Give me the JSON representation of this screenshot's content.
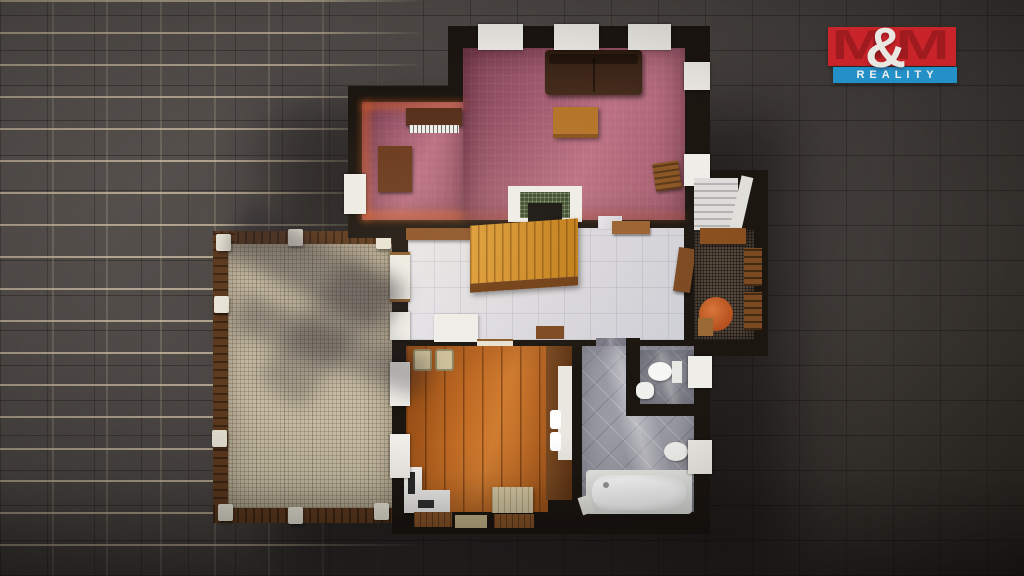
{
  "scene": {
    "type": "3d-floorplan-top-down-render",
    "description": "Real-estate 3D render of a house ground-floor plan placed on a dark gray ceramic tile background",
    "palette": {
      "background_tile_dark": "#46413e",
      "background_grout_light": "#d8c9aa",
      "wall_black": "#1c1611",
      "living_room_pink": "#b06a7c",
      "hallway_marble": "#dfdfe3",
      "wood_floor_orange": "#bc6a22",
      "terrace_beige": "#c6bca4",
      "bathroom_gray": "#9b9ba5",
      "balcony_dark_brown": "#584a3d",
      "staircase_gold": "#d9992e",
      "window_white": "#eeede7",
      "glow_orange": "#ff7323"
    }
  },
  "logo": {
    "m_left": "M",
    "ampersand": "&",
    "m_right": "M",
    "banner": "REALITY",
    "colors": {
      "block_red": "#c8242a",
      "letter_dark_red": "#a01b20",
      "banner_blue": "#2390c7",
      "text_white": "#eae8e3"
    }
  },
  "floorplan": {
    "rooms": [
      {
        "name": "living-room",
        "floor": "pink-mauve carpet",
        "furniture": [
          "sofa",
          "upright-piano",
          "desk",
          "table",
          "chair",
          "fireplace"
        ]
      },
      {
        "name": "hallway",
        "floor": "white-marble tiles",
        "furniture": [
          "wooden-staircase",
          "wood-shelf",
          "white-rug",
          "doormat",
          "radiator-shelf",
          "balcony-door"
        ]
      },
      {
        "name": "terrace",
        "floor": "beige-stone mosaic",
        "furniture": [
          "wood-railing",
          "white-posts",
          "tree-shadows"
        ]
      },
      {
        "name": "kitchen-living-room",
        "floor": "wood-planks",
        "furniture": [
          "pouf",
          "pouf",
          "white-desk-counter",
          "bench",
          "kitchen-counter",
          "sink-basins"
        ]
      },
      {
        "name": "bathroom",
        "floor": "gray-diagonal-tiles",
        "furniture": [
          "bathtub",
          "bidet",
          "door"
        ]
      },
      {
        "name": "wc",
        "floor": "gray-diagonal-tiles",
        "furniture": [
          "toilet",
          "small-sink"
        ]
      },
      {
        "name": "balcony",
        "floor": "dark-speckled-stone",
        "furniture": [
          "table",
          "chair",
          "chair",
          "round-pouf",
          "crate"
        ]
      },
      {
        "name": "exterior-staircase",
        "floor": "concrete-steps",
        "furniture": [
          "white-parapet"
        ]
      }
    ]
  }
}
